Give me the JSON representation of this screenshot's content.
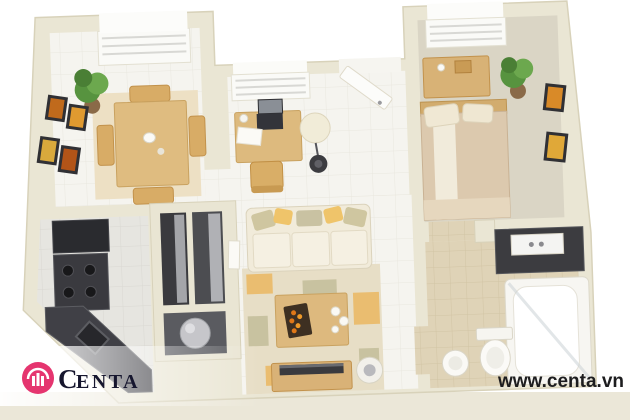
{
  "watermark": {
    "brand": "Centa",
    "brand_initial": "C",
    "brand_rest": "ENTA",
    "website": "www.centa.vn",
    "logo_color": "#e5356f",
    "text_color": "#16162e"
  },
  "scene": {
    "description": "3D top-down render of a one-bedroom apartment floor plan on a cream base",
    "palette": {
      "wall": "#eae6d4",
      "floor_tile": "#f5f4ef",
      "kitchen_tile": "#e6e5e0",
      "bath_tile": "#dfd3b7",
      "bedroom_carpet": "#dad5c5",
      "wood": "#ddb97e",
      "counter_dark": "#3a3a3e",
      "sofa_cream": "#f1ebda",
      "rug_beige": "#e7dec6",
      "accent_orange": "#eabd70",
      "plant_green": "#5e9643"
    },
    "rooms": [
      {
        "name": "dining-room",
        "furniture": [
          "dining table",
          "four chairs",
          "corner plant",
          "four framed pictures",
          "window with blinds",
          "beige rug"
        ]
      },
      {
        "name": "office-nook",
        "furniture": [
          "desk",
          "laptop",
          "papers",
          "desk chair",
          "floor lamp",
          "window with blinds",
          "open entry door"
        ]
      },
      {
        "name": "bedroom",
        "furniture": [
          "double bed",
          "dresser",
          "corner plant",
          "two framed pictures",
          "window with blinds"
        ]
      },
      {
        "name": "kitchen",
        "furniture": [
          "tall dark cabinet",
          "stove with four burners",
          "diagonal counter with sink"
        ]
      },
      {
        "name": "utility-closet",
        "furniture": [
          "two shelved compartments",
          "water heater cylinder"
        ]
      },
      {
        "name": "living-room",
        "furniture": [
          "cream sofa with pillows",
          "patchwork rug",
          "coffee table with tray and candles",
          "tv stand with tv",
          "round stool"
        ]
      },
      {
        "name": "bathroom",
        "furniture": [
          "vanity with sink",
          "bathtub",
          "toilet",
          "pedestal sink"
        ]
      }
    ]
  }
}
